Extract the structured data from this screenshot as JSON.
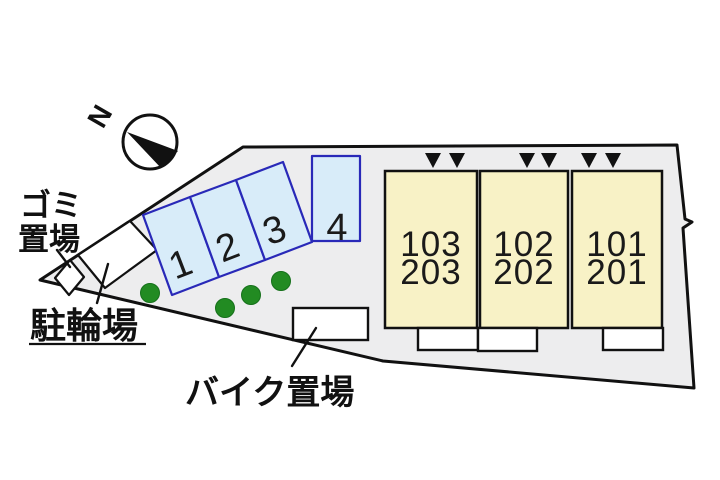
{
  "compass": {
    "label": "N"
  },
  "areas": {
    "garbage_label_line1": "ゴミ",
    "garbage_label_line2": "置場",
    "bicycle_label": "駐輪場",
    "motorcycle_label": "バイク置場"
  },
  "parking": {
    "spaces": [
      "1",
      "2",
      "3",
      "4"
    ]
  },
  "building": {
    "units": [
      {
        "line1": "103",
        "line2": "203"
      },
      {
        "line1": "102",
        "line2": "202"
      },
      {
        "line1": "101",
        "line2": "201"
      }
    ]
  },
  "markers": {
    "entrance_triangle_count": 6,
    "bush_count": 4
  },
  "colors": {
    "plot_fill": "#ededee",
    "parking_fill": "#d8ecf9",
    "parking_border": "#2929b8",
    "building_fill": "#f8f2c6",
    "bush_green": "#228b22",
    "line_black": "#111111"
  }
}
